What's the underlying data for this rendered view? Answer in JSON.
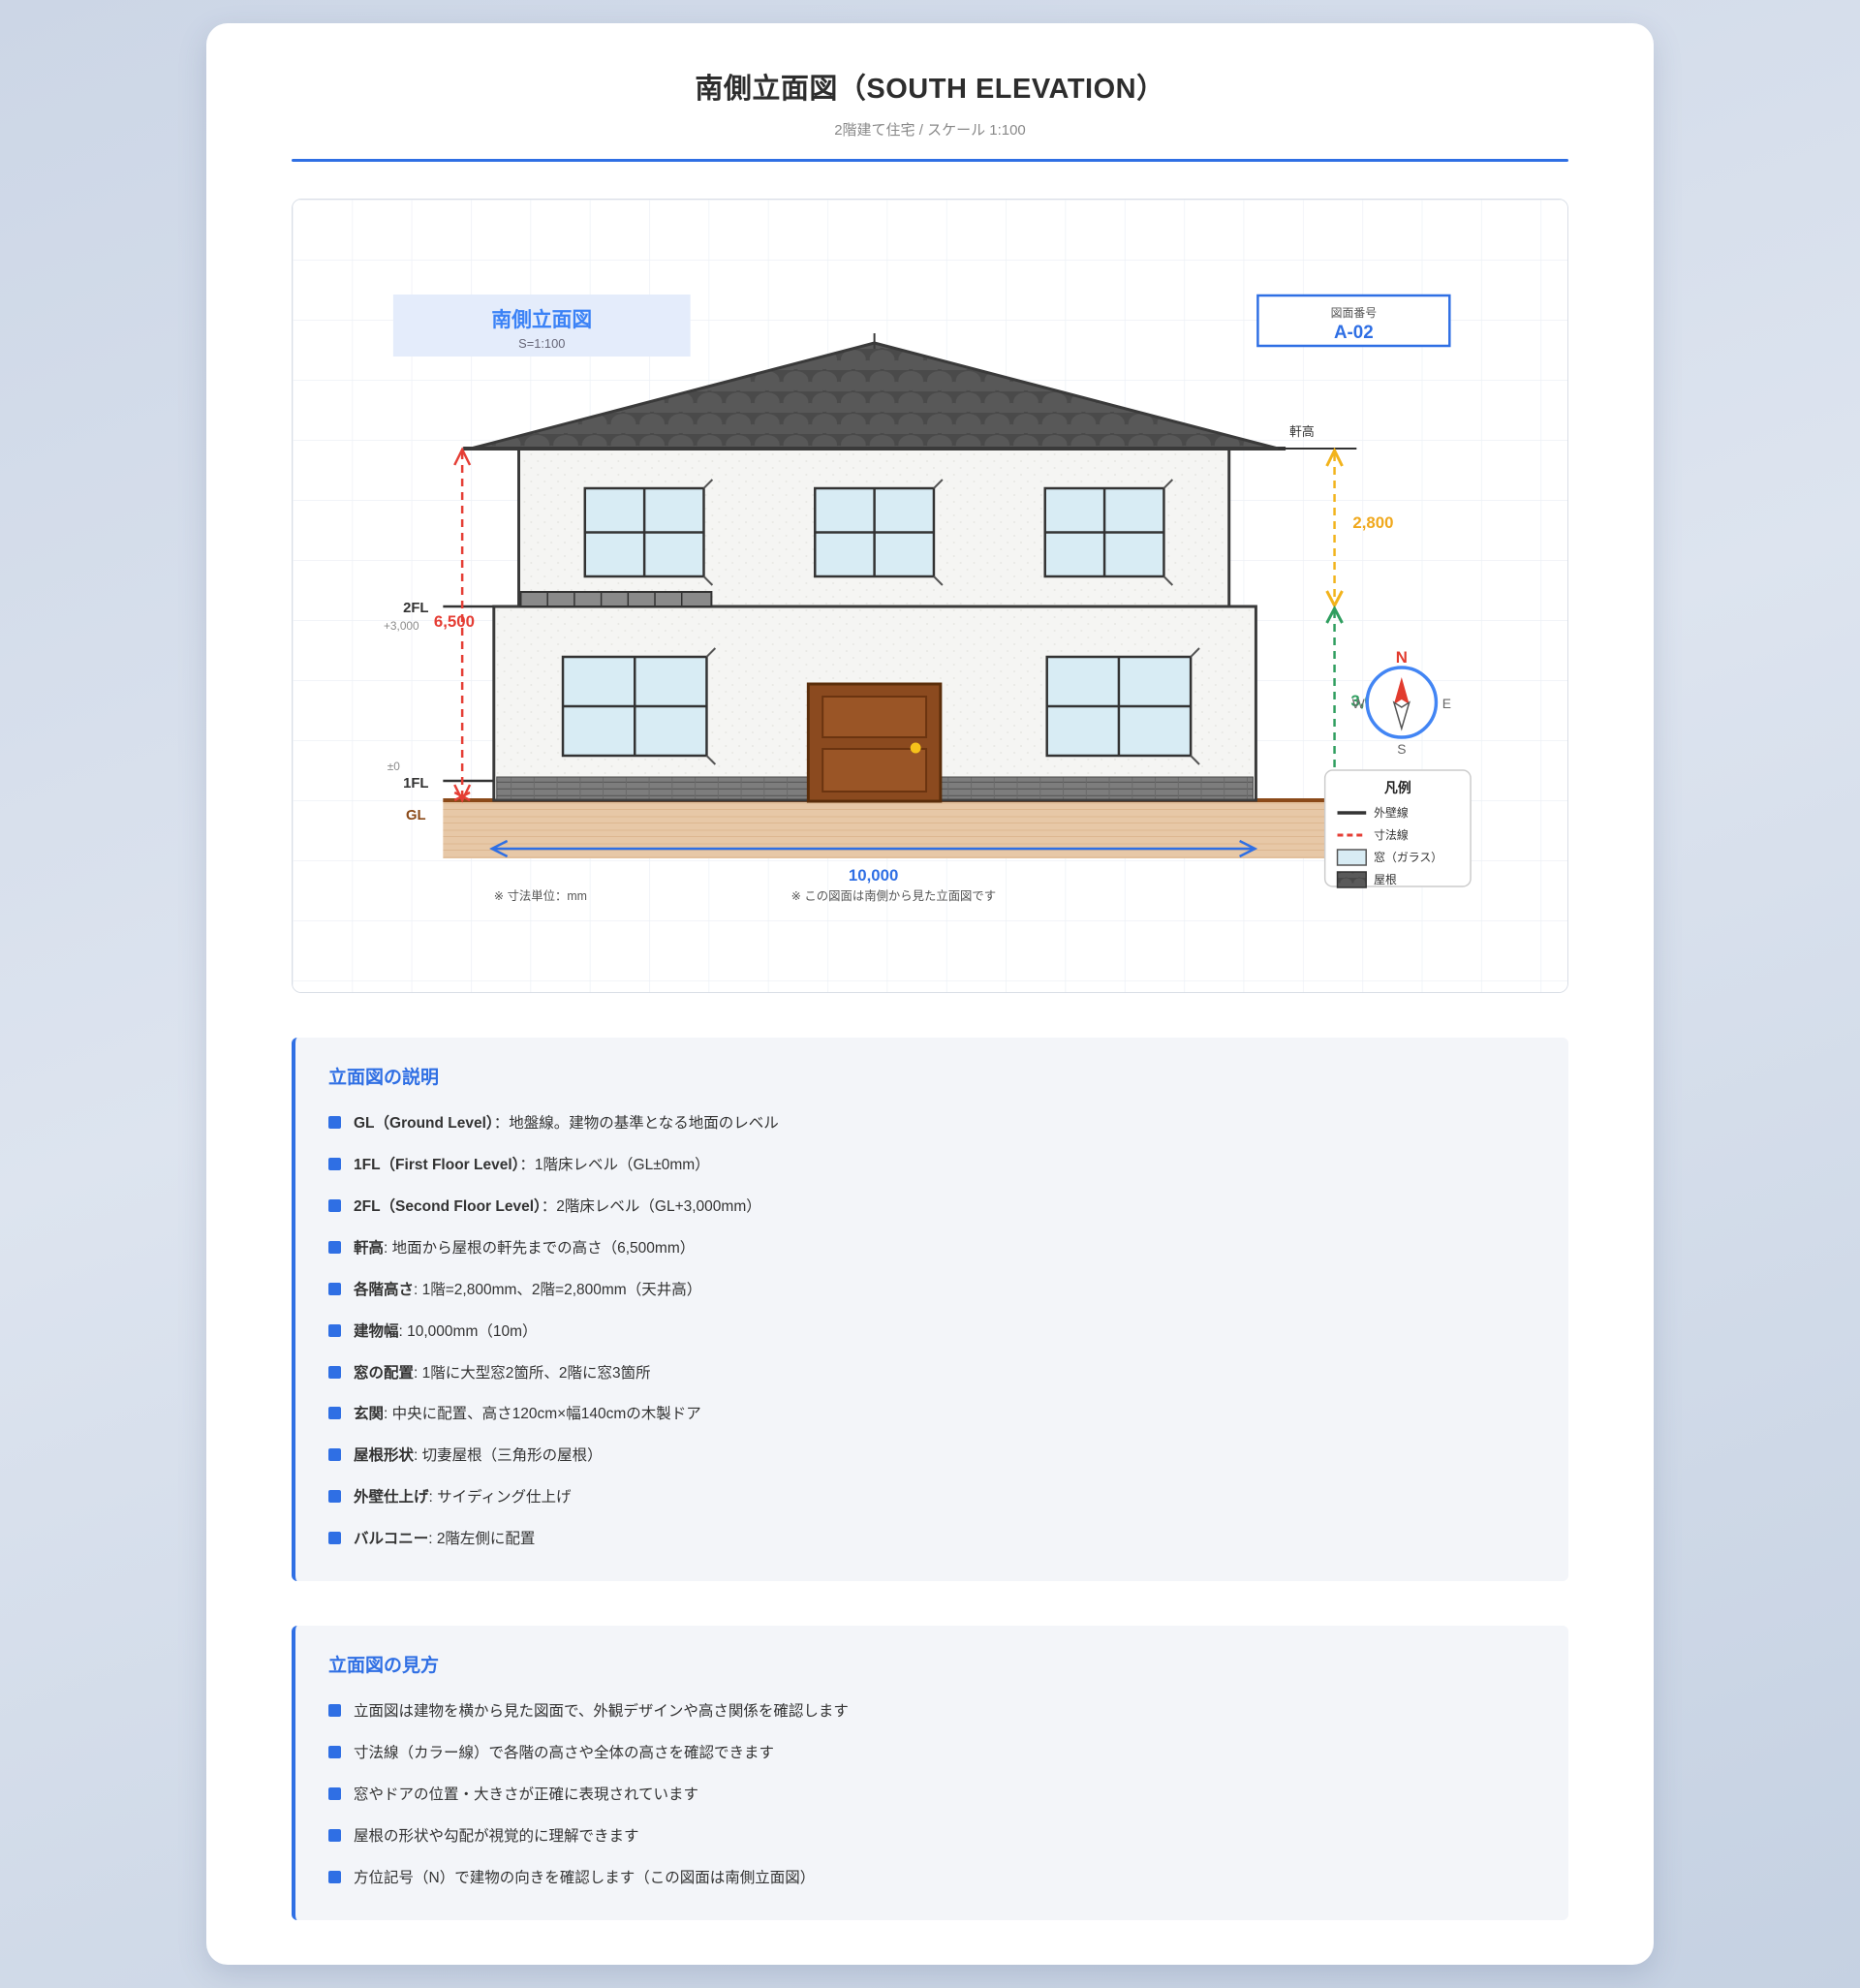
{
  "page": {
    "title": "南側立面図（SOUTH ELEVATION）",
    "subtitle": "2階建て住宅 / スケール 1:100"
  },
  "drawing": {
    "label": {
      "title": "南側立面図",
      "scale": "S=1:100"
    },
    "number": {
      "caption": "図面番号",
      "value": "A-02"
    },
    "dims": {
      "eave_label": "軒高",
      "total_height": "6,500",
      "floor2_height": "2,800",
      "floor1_height": "3,000",
      "building_width": "10,000",
      "fl2": "2FL",
      "fl2_offset": "+3,000",
      "fl1": "1FL",
      "fl1_offset": "±0",
      "gl": "GL"
    },
    "compass": {
      "n": "N",
      "e": "E",
      "s": "S",
      "w": "W"
    },
    "legend": {
      "title": "凡例",
      "wall_line": "外壁線",
      "dim_line": "寸法線",
      "window": "窓（ガラス）",
      "roof": "屋根"
    },
    "notes": {
      "unit": "※ 寸法単位：mm",
      "view": "※ この図面は南側から見た立面図です"
    },
    "colors": {
      "accent_blue": "#2f6fe4",
      "dim_red": "#e53e35",
      "dim_yellow": "#f0a81c",
      "dim_green": "#2f9e5f",
      "gl_brown": "#8b4a19",
      "roof_gray": "#4d4d4d",
      "window_glass": "#d8ecf4",
      "door_brown": "#8b4a1f",
      "ground_tan": "#e7c8a7"
    }
  },
  "sections": [
    {
      "title": "立面図の説明",
      "items": [
        {
          "lead": "GL（Ground Level）",
          "rest": "：地盤線。建物の基準となる地面のレベル"
        },
        {
          "lead": "1FL（First Floor Level）",
          "rest": "：1階床レベル（GL±0mm）"
        },
        {
          "lead": "2FL（Second Floor Level）",
          "rest": "：2階床レベル（GL+3,000mm）"
        },
        {
          "lead": "軒高",
          "rest": ": 地面から屋根の軒先までの高さ（6,500mm）"
        },
        {
          "lead": "各階高さ",
          "rest": ": 1階=2,800mm、2階=2,800mm（天井高）"
        },
        {
          "lead": "建物幅",
          "rest": ": 10,000mm（10m）"
        },
        {
          "lead": "窓の配置",
          "rest": ": 1階に大型窓2箇所、2階に窓3箇所"
        },
        {
          "lead": "玄関",
          "rest": ": 中央に配置、高さ120cm×幅140cmの木製ドア"
        },
        {
          "lead": "屋根形状",
          "rest": ": 切妻屋根（三角形の屋根）"
        },
        {
          "lead": "外壁仕上げ",
          "rest": ": サイディング仕上げ"
        },
        {
          "lead": "バルコニー",
          "rest": ": 2階左側に配置"
        }
      ]
    },
    {
      "title": "立面図の見方",
      "items": [
        {
          "lead": "",
          "rest": "立面図は建物を横から見た図面で、外観デザインや高さ関係を確認します"
        },
        {
          "lead": "",
          "rest": "寸法線（カラー線）で各階の高さや全体の高さを確認できます"
        },
        {
          "lead": "",
          "rest": "窓やドアの位置・大きさが正確に表現されています"
        },
        {
          "lead": "",
          "rest": "屋根の形状や勾配が視覚的に理解できます"
        },
        {
          "lead": "",
          "rest": "方位記号（N）で建物の向きを確認します（この図面は南側立面図）"
        }
      ]
    }
  ]
}
